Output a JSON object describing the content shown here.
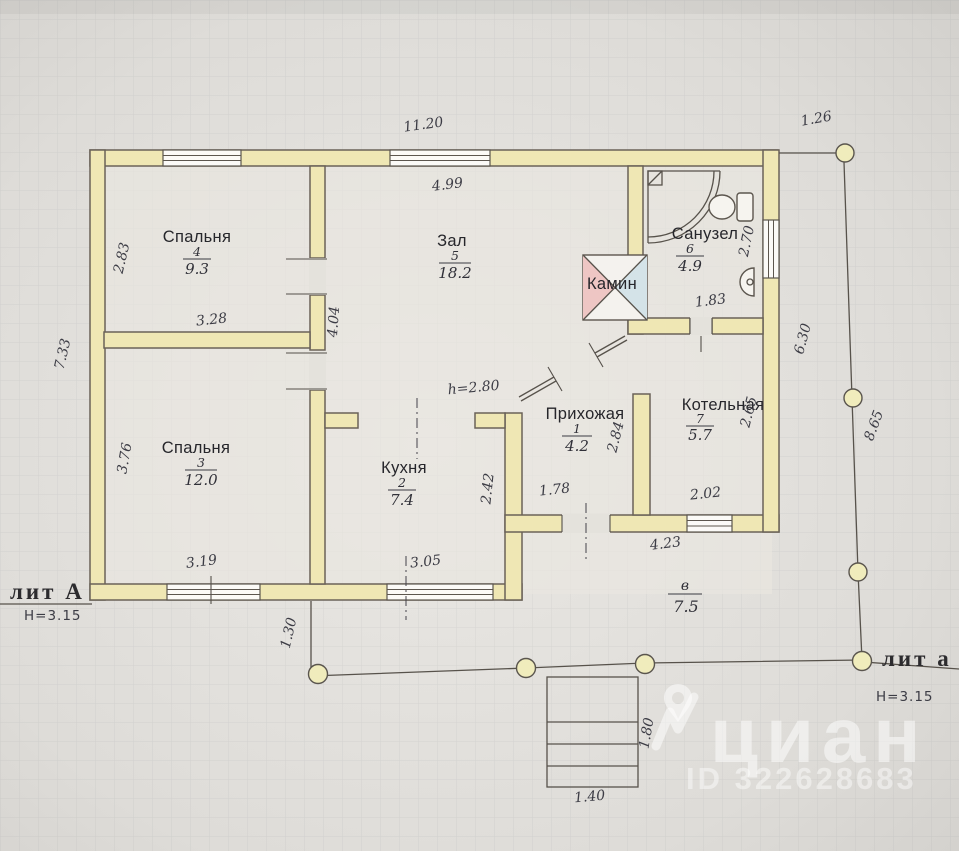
{
  "plan": {
    "litera_main": {
      "label": "лит А",
      "height": "Н=3.15"
    },
    "litera_porch": {
      "label": "лит а",
      "height": "Н=3.15"
    },
    "fireplace_label": "Камин",
    "rooms": [
      {
        "name": "Спальня",
        "number": "4",
        "area": "9.3"
      },
      {
        "name": "Зал",
        "number": "5",
        "area": "18.2"
      },
      {
        "name": "Санузел",
        "number": "6",
        "area": "4.9"
      },
      {
        "name": "Кухня",
        "number": "2",
        "area": "7.4"
      },
      {
        "name": "Спальня",
        "number": "3",
        "area": "12.0"
      },
      {
        "name": "Прихожая",
        "number": "1",
        "area": "4.2"
      },
      {
        "name": "Котельная",
        "number": "7",
        "area": "5.7"
      },
      {
        "name": "",
        "number": "в",
        "area": "7.5"
      }
    ],
    "dimensions": [
      "11.20",
      "1.26",
      "4.99",
      "2.83",
      "3.28",
      "7.33",
      "4.04",
      "3.76",
      "3.19",
      "h=2.80",
      "2.42",
      "3.05",
      "1.30",
      "1.78",
      "2.84",
      "4.23",
      "2.02",
      "2.65",
      "2.70",
      "1.83",
      "6.30",
      "8.65",
      "1.80",
      "1.40"
    ]
  },
  "watermark": {
    "brand": "циан",
    "id_label": "ID 322628683"
  },
  "colors": {
    "paper": "#dcdad6",
    "wall_fill": "#efe7b4",
    "wall_stroke": "#6a6258",
    "fireplace_pink": "#eec6c4",
    "fireplace_blue": "#d4e3e8",
    "column_fill": "#f0ecbc"
  }
}
